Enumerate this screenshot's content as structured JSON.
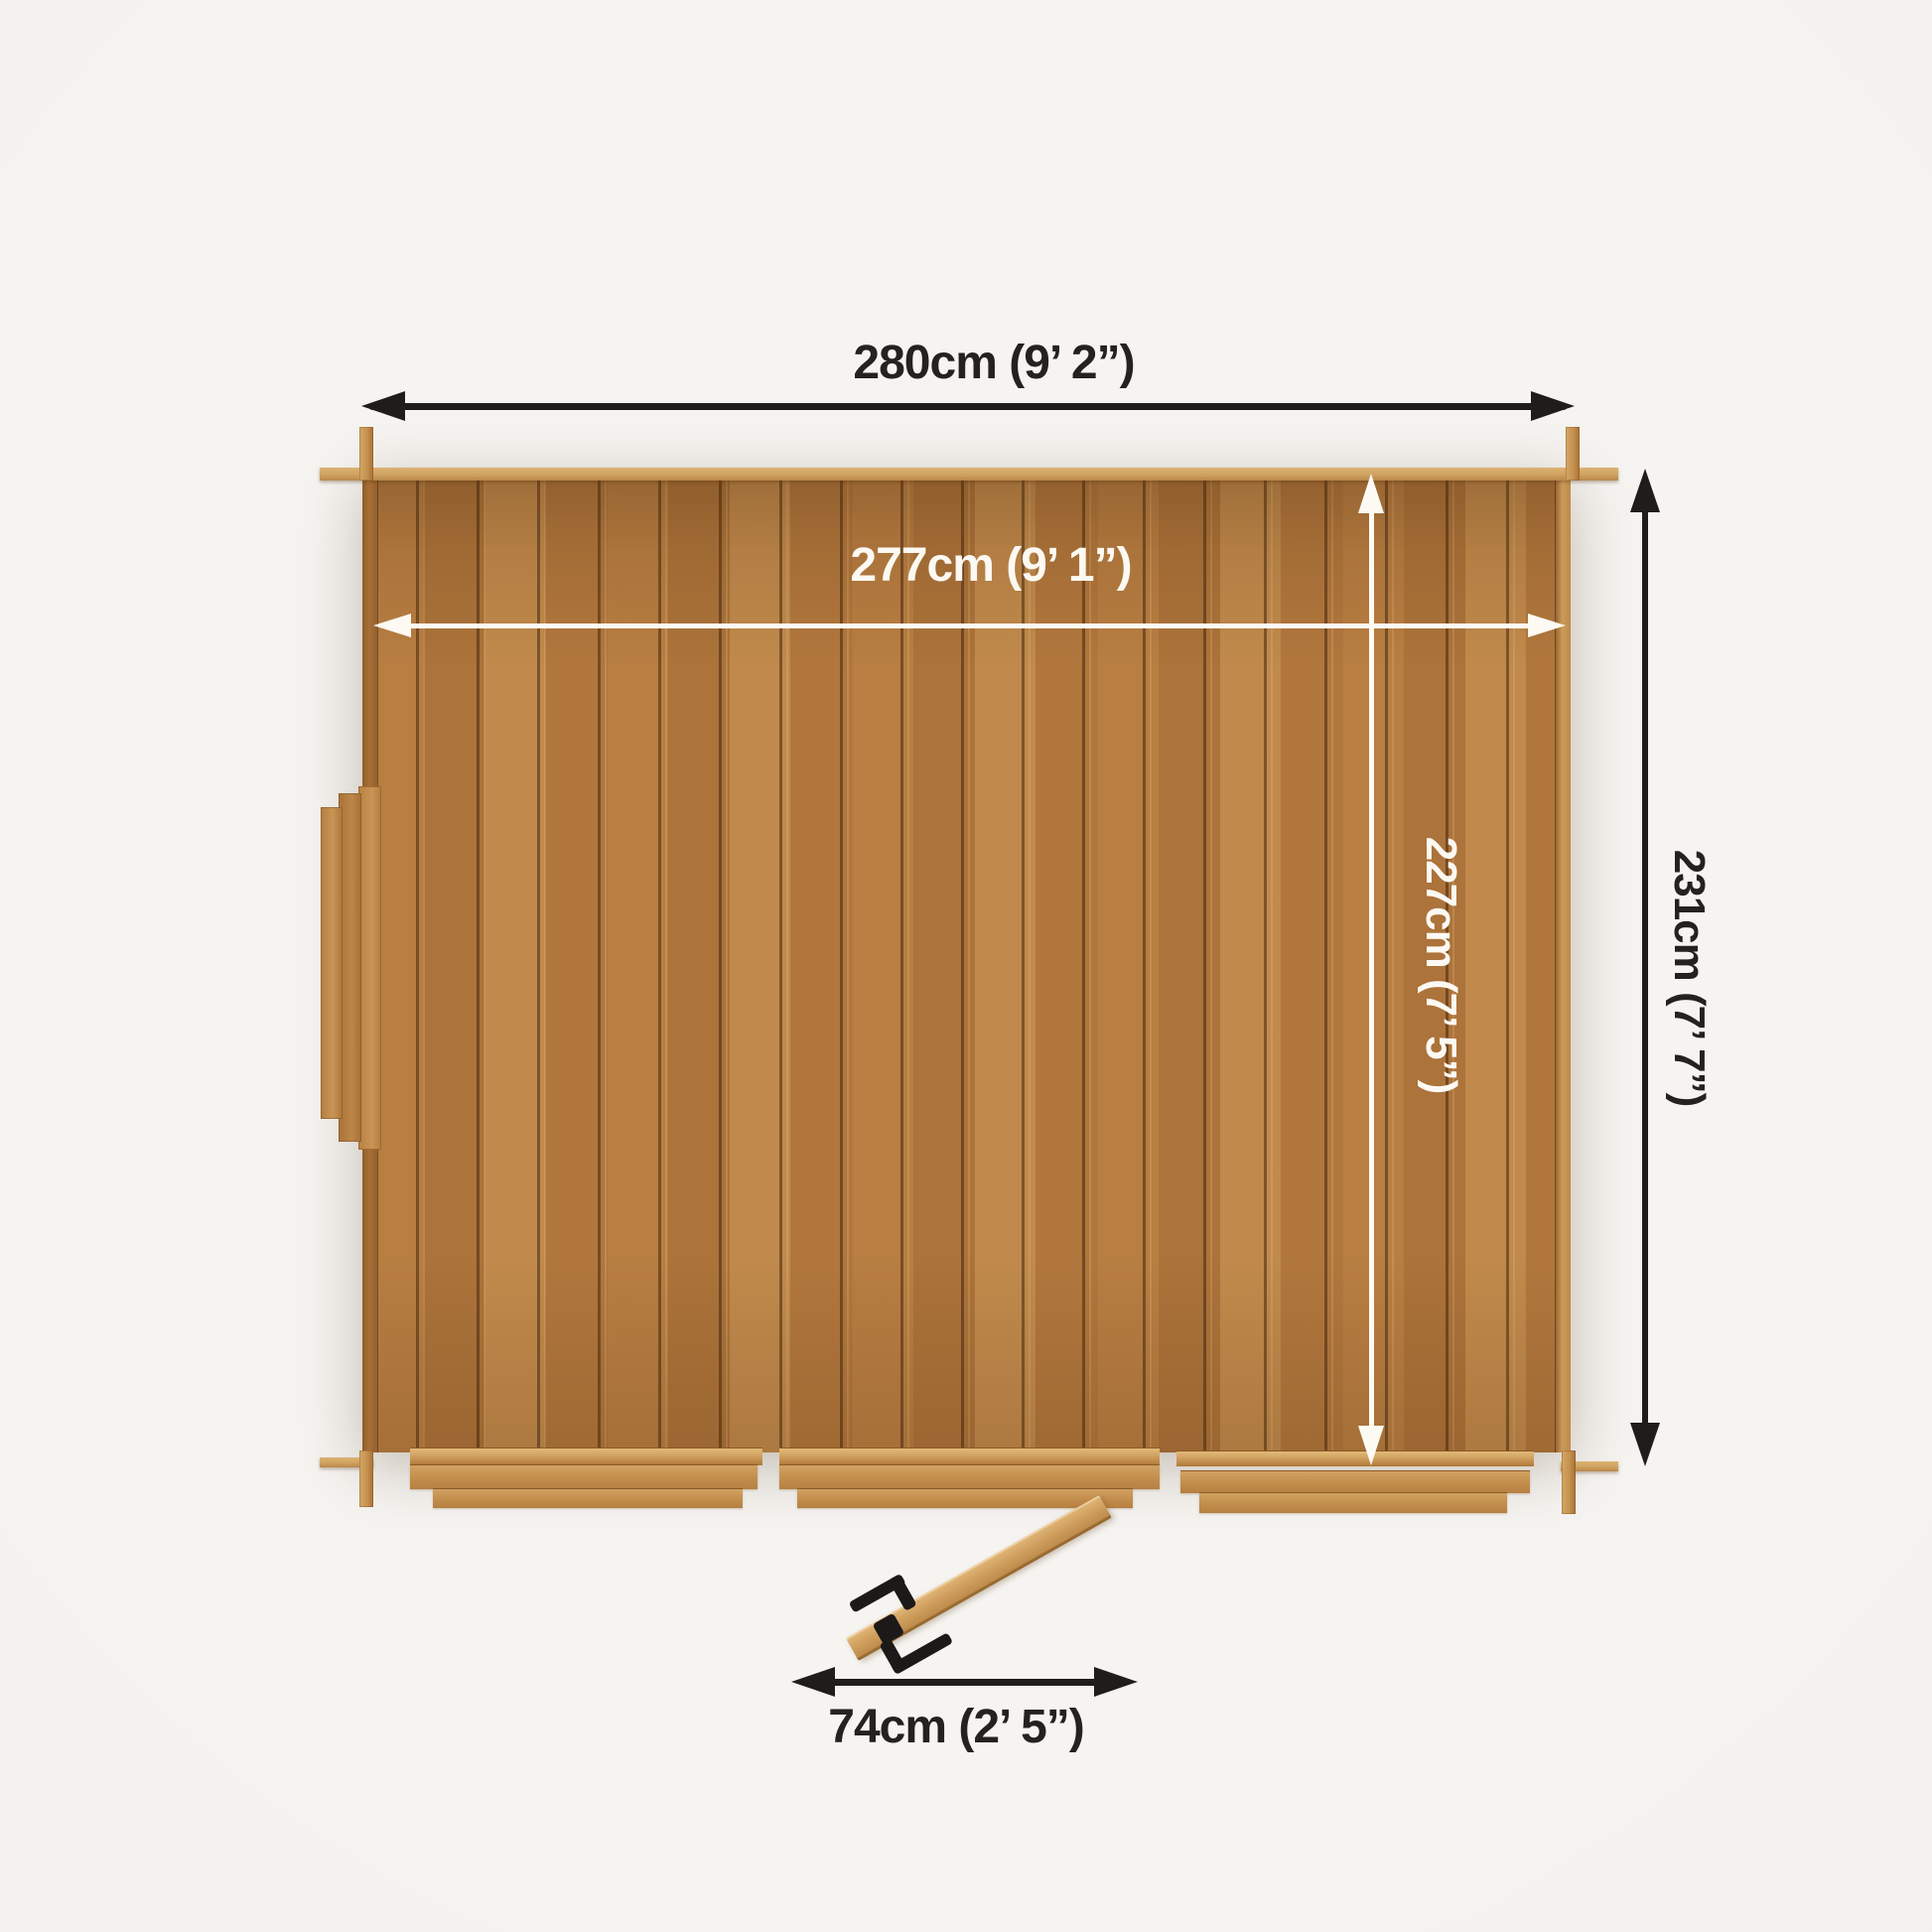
{
  "page": {
    "title": "Garden log cabin - top-down floor plan with dimensions",
    "view": "plan (top-down)"
  },
  "dimensions": {
    "outer_width": {
      "label": "280cm (9’ 2”)",
      "cm": 280,
      "ft_in": "9’ 2”",
      "orientation": "horizontal",
      "style": "outer-black"
    },
    "inner_width": {
      "label": "277cm (9’ 1”)",
      "cm": 277,
      "ft_in": "9’ 1”",
      "orientation": "horizontal",
      "style": "inner-white"
    },
    "inner_depth": {
      "label": "227cm (7’ 5”)",
      "cm": 227,
      "ft_in": "7’ 5”",
      "orientation": "vertical",
      "style": "inner-white"
    },
    "outer_depth": {
      "label": "231cm (7’ 7”)",
      "cm": 231,
      "ft_in": "7’ 7”",
      "orientation": "vertical",
      "style": "outer-black"
    },
    "door_width": {
      "label": "74cm (2’ 5”)",
      "cm": 74,
      "ft_in": "2’ 5”",
      "orientation": "horizontal",
      "style": "outer-black"
    }
  },
  "colors": {
    "background": "#f4f2ef",
    "wood_base": "#b87e42",
    "wood_light": "#cfa260",
    "wood_dark": "#8f5c2b",
    "outer_dimension": "#1f1d1b",
    "inner_dimension": "#fdfaf4",
    "door_handle": "#1b1a18"
  },
  "parts": {
    "cabin_body": "log cabin roof/floor panel, vertical planks",
    "window": "side window protrusion on left wall",
    "door": "single door shown swung open at bottom",
    "steps": "three step/skid boards along bottom edge",
    "corner_logs": "interlocking corner log joints"
  }
}
